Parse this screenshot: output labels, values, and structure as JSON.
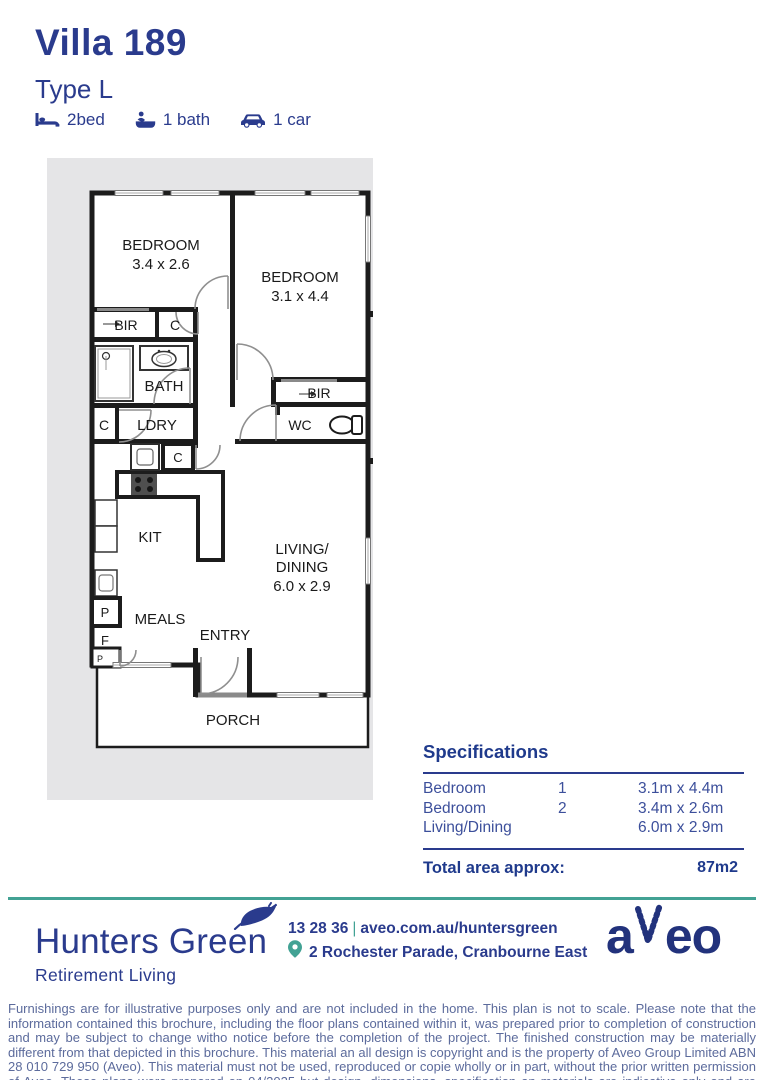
{
  "header": {
    "title": "Villa 189",
    "subtitle": "Type L",
    "features": [
      {
        "icon": "bed-icon",
        "label": "2bed"
      },
      {
        "icon": "bath-icon",
        "label": "1 bath"
      },
      {
        "icon": "car-icon",
        "label": "1 car"
      }
    ]
  },
  "floorplan": {
    "bedroom2_name": "BEDROOM",
    "bedroom2_dims": "3.4 x 2.6",
    "bedroom1_name": "BEDROOM",
    "bedroom1_dims": "3.1 x 4.4",
    "bir1": "BIR",
    "c1": "C",
    "bath": "BATH",
    "c2": "C",
    "ldry": "LDRY",
    "bir2": "BIR",
    "wc": "WC",
    "c3": "C",
    "kit": "KIT",
    "living_line1": "LIVING/",
    "living_line2": "DINING",
    "living_dims": "6.0 x 2.9",
    "meals": "MEALS",
    "entry": "ENTRY",
    "porch": "PORCH",
    "p1": "P",
    "f": "F",
    "p2": "P"
  },
  "specifications": {
    "heading": "Specifications",
    "rows": [
      {
        "label": "Bedroom",
        "number": "1",
        "dimensions": "3.1m x 4.4m"
      },
      {
        "label": "Bedroom",
        "number": "2",
        "dimensions": "3.4m x 2.6m"
      },
      {
        "label": "Living/Dining",
        "number": "",
        "dimensions": "6.0m x 2.9m"
      }
    ],
    "total_label": "Total area approx:",
    "total_value": "87m2"
  },
  "footer": {
    "brand_name": "Hunters Green",
    "brand_tagline": "Retirement Living",
    "phone": "13 28 36",
    "separator": "|",
    "website": "aveo.com.au/huntersgreen",
    "address": "2 Rochester Parade, Cranbourne East",
    "logo_text_a": "a",
    "logo_text_eo": "eo"
  },
  "disclaimer": "Furnishings are for illustrative purposes only and are not included in the home. This plan is not to scale. Please note that the information contained this brochure, including the floor plans contained within it, was prepared prior to completion of construction and may be subject to change witho notice before the completion of the project. The finished construction may be materially different from that depicted in this brochure. This material an all design is copyright and is the property of Aveo Group Limited ABN 28 010 729 950 (Aveo). This material must not be used, reproduced or copie wholly or in part, without the prior written permission of Aveo. These plans were prepared on 04/2025 but design, dimensions, specification an materials are indicative only and are subject to change without notice at anytime and intending purchasers should undertake their own independe inquiries to satisfy themselves regarding the status of these plans. You should refer to appropriate Survey Plans for confirmation of individual un areas.",
  "colors": {
    "navy": "#2a3b8d",
    "navy_dark": "#1f3a8c",
    "teal": "#42a294",
    "wall": "#1c1c1c",
    "panel_bg": "#e5e5e7",
    "disclaimer_text": "#5c6b9c"
  }
}
